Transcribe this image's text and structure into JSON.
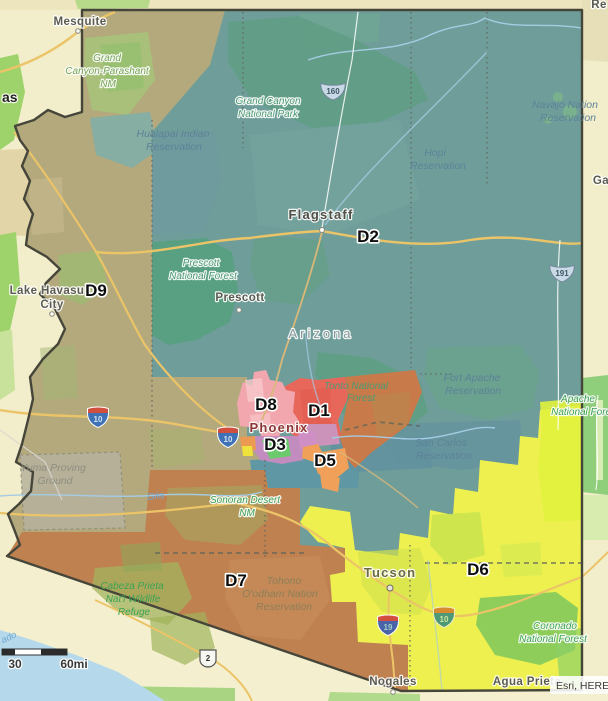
{
  "map": {
    "attribution": "Esri, HERE",
    "scale": {
      "mid": "30",
      "end": "60mi"
    },
    "state_label": "Arizona",
    "district_labels": {
      "d1": "D1",
      "d2": "D2",
      "d3": "D3",
      "d5": "D5",
      "d6": "D6",
      "d7": "D7",
      "d8": "D8",
      "d9": "D9"
    },
    "cities": {
      "mesquite": "Mesquite",
      "flagstaff": "Flagstaff",
      "prescott": "Prescott",
      "phoenix": "Phoenix",
      "tucson": "Tucson",
      "nogales": "Nogales",
      "agua_prieta": "Agua Prieta",
      "lake_havasu_line1": "Lake Havasu",
      "lake_havasu_line2": "City",
      "las_vegas_fragment": "as",
      "gallup_fragment": "Ga",
      "reservation_fragment": "Re"
    },
    "areas": {
      "grand_canyon_parashant": {
        "lines": [
          "Grand",
          "Canyon-Parashant",
          "NM"
        ]
      },
      "grand_canyon_np": {
        "lines": [
          "Grand Canyon",
          "National Park"
        ]
      },
      "hualapai": {
        "lines": [
          "Hualapai Indian",
          "Reservation"
        ]
      },
      "hopi": {
        "lines": [
          "Hopi",
          "Reservation"
        ]
      },
      "navajo": {
        "lines": [
          "Navajo Nation",
          "Reservation"
        ]
      },
      "prescott_nf": {
        "lines": [
          "Prescott",
          "National Forest"
        ]
      },
      "tonto_nf": {
        "lines": [
          "Tonto National",
          "Forest"
        ]
      },
      "fort_apache": {
        "lines": [
          "Fort Apache",
          "Reservation"
        ]
      },
      "san_carlos": {
        "lines": [
          "San Carlos",
          "Reservation"
        ]
      },
      "apache_nf": {
        "lines": [
          "Apache",
          "National Forest"
        ]
      },
      "sonoran_desert": {
        "lines": [
          "Sonoran Desert",
          "NM"
        ]
      },
      "cabeza_prieta": {
        "lines": [
          "Cabeza Prieta",
          "Nat'l Wildlife",
          "Refuge"
        ]
      },
      "coronado_nf": {
        "lines": [
          "Coronado",
          "National Forest"
        ]
      },
      "tohono": {
        "lines": [
          "Tohono",
          "O'odham Nation",
          "Reservation"
        ]
      },
      "yuma_proving": {
        "lines": [
          "Yuma Proving",
          "Ground"
        ]
      }
    },
    "rivers": {
      "gila": "Gila",
      "colorado_fragment": "ado"
    },
    "highways": {
      "us160": "160",
      "us191": "191",
      "i10": "10",
      "i19": "19",
      "mx2": "2"
    },
    "colors": {
      "d1_red": "#E7685A",
      "d1_brown": "#C87A4A",
      "d2_teal": "#6F9E9A",
      "d3_purple": "#C38CBE",
      "d5_orange": "#F0A058",
      "d6_yellow": "#EDF04F",
      "d7_brown": "#C08150",
      "d8_pink": "#F2A7AF",
      "d9_olive": "#B3A97D",
      "water": "#B5D9EA",
      "road": "#ECC468",
      "border": "#45453A"
    }
  }
}
